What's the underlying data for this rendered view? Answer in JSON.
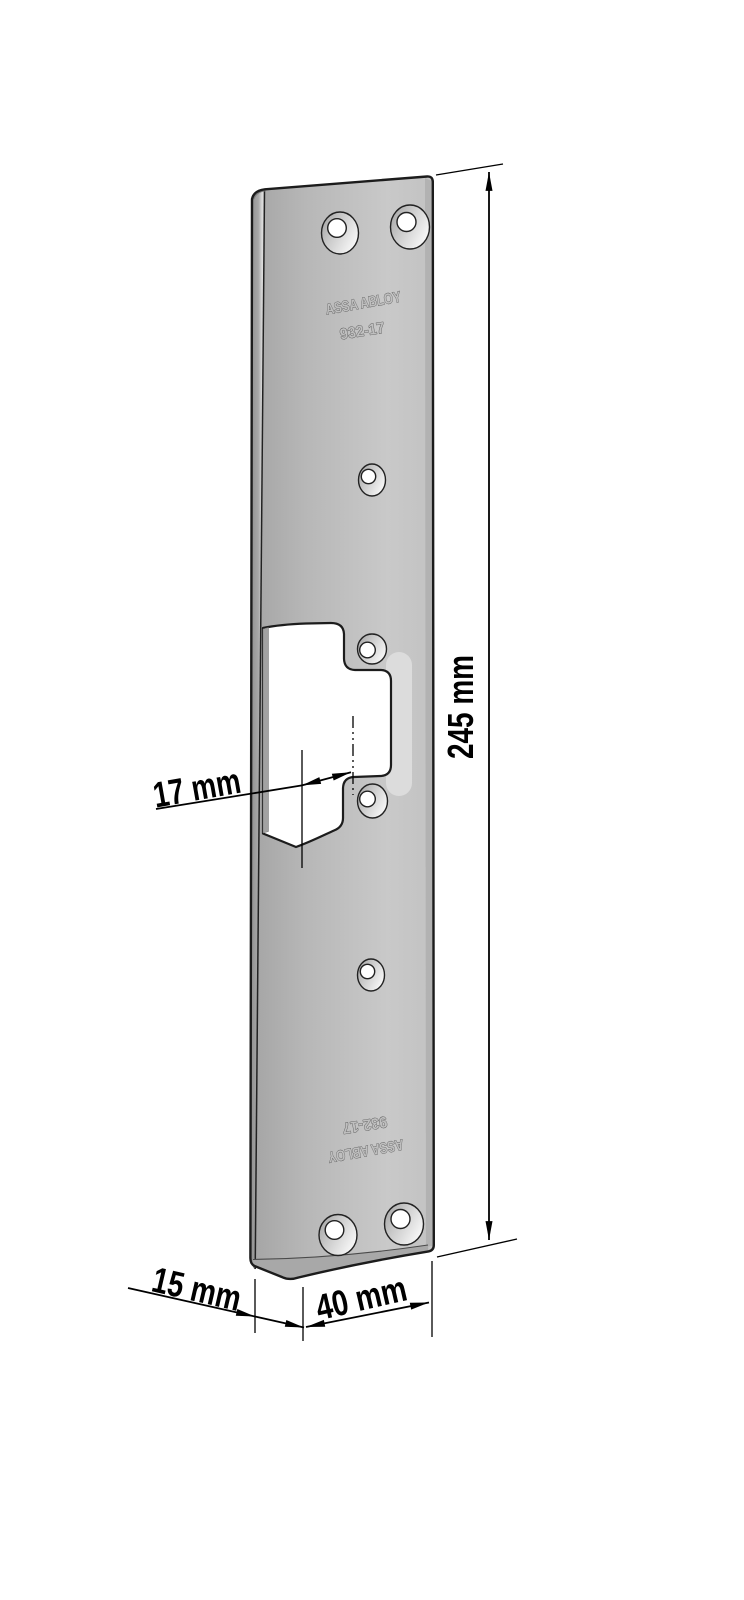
{
  "plate": {
    "brand_top": "ASSA ABLOY",
    "model_top": "932-17",
    "model_bottom": "932-17",
    "brand_bottom": "ASSA ABLOY"
  },
  "dimensions": {
    "height": "245 mm",
    "latch_center_offset": "17 mm",
    "flange_depth": "15 mm",
    "face_width": "40 mm"
  },
  "colors": {
    "background": "#ffffff",
    "plate_dark": "#a4a4a4",
    "plate_light": "#c9c9c9",
    "outline": "#1c1c1c",
    "dimension": "#000000"
  }
}
